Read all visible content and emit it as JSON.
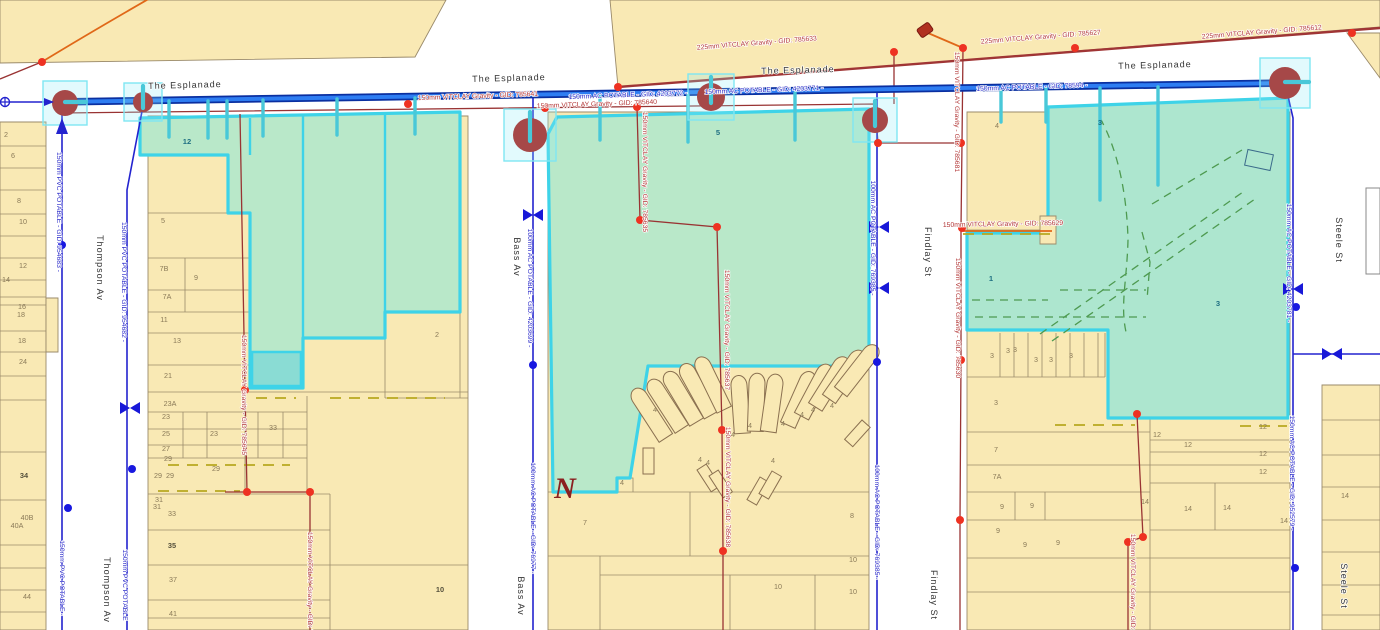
{
  "map": {
    "colors": {
      "water_main": "#2e7df2",
      "water_casing": "#0a2fa0",
      "water_thin": "#2323cf",
      "sewer": "#993333",
      "sewer_trunk": "#a03535",
      "sewer_node": "#ee3222",
      "selection": "#3ed3e8",
      "selection_fill": "#b9e8c9",
      "selection_fill_alt": "#ade6cf",
      "selection_fill_bright": "#8adcd4",
      "parcel_fill": "#f9e9b4",
      "parcel_stroke": "#9a8a6a",
      "easement": "#b8a820",
      "drain_dash": "#4e9a50",
      "manhole": "#a64848",
      "label_blue": "#2929c9",
      "label_red": "#b23535",
      "street_text": "#333333",
      "parcel_text": "#8a7a58",
      "orange": "#e06818"
    },
    "labels": [
      {
        "t": "The Esplanade",
        "x": 185,
        "y": 88,
        "r": -1.5,
        "k": "st"
      },
      {
        "t": "The Esplanade",
        "x": 509,
        "y": 81,
        "r": -1.5,
        "k": "st"
      },
      {
        "t": "The Esplanade",
        "x": 798,
        "y": 73,
        "r": -1.5,
        "k": "st"
      },
      {
        "t": "The Esplanade",
        "x": 1155,
        "y": 68,
        "r": -1.5,
        "k": "st"
      },
      {
        "t": "Thompson Av",
        "x": 97,
        "y": 268,
        "r": 90,
        "k": "st"
      },
      {
        "t": "Thompson Av",
        "x": 104,
        "y": 590,
        "r": 90,
        "k": "st"
      },
      {
        "t": "Bass Av",
        "x": 514,
        "y": 257,
        "r": 90,
        "k": "st"
      },
      {
        "t": "Bass Av",
        "x": 518,
        "y": 596,
        "r": 90,
        "k": "st"
      },
      {
        "t": "Findlay St",
        "x": 925,
        "y": 252,
        "r": 90,
        "k": "st"
      },
      {
        "t": "Findlay St",
        "x": 931,
        "y": 595,
        "r": 90,
        "k": "st"
      },
      {
        "t": "Steele St",
        "x": 1336,
        "y": 240,
        "r": 90,
        "k": "st"
      },
      {
        "t": "Steele St",
        "x": 1341,
        "y": 586,
        "r": 90,
        "k": "st"
      },
      {
        "t": "150mm AC POTABLE - GID: 4203772 -",
        "x": 628,
        "y": 97,
        "r": -2,
        "k": "wb"
      },
      {
        "t": "150mm AC POTABLE - GID: 4203771 -",
        "x": 764,
        "y": 92,
        "r": -2,
        "k": "wb"
      },
      {
        "t": "150mm AC POTABLE - GID: 78594 -",
        "x": 1032,
        "y": 89,
        "r": -2,
        "k": "wb"
      },
      {
        "t": "150mm PVC POTABLE - GID: 954683 -",
        "x": 57,
        "y": 212,
        "r": 90,
        "k": "wb"
      },
      {
        "t": "150mm PVC POTABLE - GID: 954682 -",
        "x": 122,
        "y": 282,
        "r": 90,
        "k": "wb"
      },
      {
        "t": "150mm PVC POTABLE -",
        "x": 60,
        "y": 578,
        "r": 90,
        "k": "wb"
      },
      {
        "t": "150mm PVC POTABLE",
        "x": 123,
        "y": 585,
        "r": 90,
        "k": "wb"
      },
      {
        "t": "100mm AC POTABLE - GID: 4203699 -",
        "x": 528,
        "y": 288,
        "r": 90,
        "k": "wb"
      },
      {
        "t": "100mm AC POTABLE - GID: 76977 -",
        "x": 531,
        "y": 518,
        "r": 90,
        "k": "wb"
      },
      {
        "t": "100mm AC POTABLE - GID: 769385 -",
        "x": 871,
        "y": 238,
        "r": 90,
        "k": "wb"
      },
      {
        "t": "100mm AC POTABLE - GID: 769385 -",
        "x": 875,
        "y": 522,
        "r": 90,
        "k": "wb"
      },
      {
        "t": "150mm AC POTABLE - GID: 4203781 -",
        "x": 1287,
        "y": 263,
        "r": 90,
        "k": "wb"
      },
      {
        "t": "150mm AC POTABLE - GID: 952579 -",
        "x": 1290,
        "y": 473,
        "r": 90,
        "k": "wb"
      },
      {
        "t": "225mm VITCLAY Gravity - GID: 785633",
        "x": 757,
        "y": 45,
        "r": -4.5,
        "k": "sr"
      },
      {
        "t": "225mm VITCLAY Gravity - GID: 785627",
        "x": 1041,
        "y": 39,
        "r": -4.5,
        "k": "sr"
      },
      {
        "t": "225mm VITCLAY Gravity - GID: 785612",
        "x": 1262,
        "y": 34,
        "r": -4.5,
        "k": "sr"
      },
      {
        "t": "150mm VITCLAY Gravity - GID: 785641",
        "x": 478,
        "y": 98,
        "r": -2,
        "k": "sr"
      },
      {
        "t": "150mm VITCLAY Gravity - GID: 785640",
        "x": 597,
        "y": 106,
        "r": -2,
        "k": "sr"
      },
      {
        "t": "150mm VITCLAY Gravity - GID: 785635",
        "x": 643,
        "y": 172,
        "r": 90,
        "k": "sr"
      },
      {
        "t": "150mm VITCLAY Gravity - GID: 785637",
        "x": 725,
        "y": 330,
        "r": 90,
        "k": "sr"
      },
      {
        "t": "150mm VITCLAY Gravity - GID: 785638",
        "x": 726,
        "y": 487,
        "r": 90,
        "k": "sr"
      },
      {
        "t": "150mm VITCLAY Gravity - GID: 785681",
        "x": 955,
        "y": 112,
        "r": 90,
        "k": "sr"
      },
      {
        "t": "150mm VITCLAY Gravity - GID: 785630",
        "x": 956,
        "y": 318,
        "r": 90,
        "k": "sr"
      },
      {
        "t": "150mm VITCLAY Gravity - GID: 785629",
        "x": 1003,
        "y": 226,
        "r": -1,
        "k": "sr"
      },
      {
        "t": "150mm VITCLAY Gravity - GID: 785645",
        "x": 242,
        "y": 395,
        "r": 90,
        "k": "sr"
      },
      {
        "t": "150mm VITCLAY Gravity - GID: 785639",
        "x": 308,
        "y": 592,
        "r": 90,
        "k": "sr"
      },
      {
        "t": "150mm VITCLAY Gravity - GID: 785628",
        "x": 1131,
        "y": 594,
        "r": 90,
        "k": "sr"
      },
      {
        "t": "2",
        "x": 6,
        "y": 137,
        "k": "pc"
      },
      {
        "t": "6",
        "x": 13,
        "y": 158,
        "k": "pc"
      },
      {
        "t": "8",
        "x": 19,
        "y": 203,
        "k": "pc"
      },
      {
        "t": "10",
        "x": 23,
        "y": 224,
        "k": "pc"
      },
      {
        "t": "12",
        "x": 23,
        "y": 268,
        "k": "pc"
      },
      {
        "t": "14",
        "x": 6,
        "y": 282,
        "k": "pc"
      },
      {
        "t": "16",
        "x": 22,
        "y": 309,
        "k": "pc"
      },
      {
        "t": "18",
        "x": 21,
        "y": 317,
        "k": "pc"
      },
      {
        "t": "18",
        "x": 22,
        "y": 343,
        "k": "pc"
      },
      {
        "t": "24",
        "x": 23,
        "y": 364,
        "k": "pc"
      },
      {
        "t": "34",
        "x": 24,
        "y": 478,
        "k": "pb"
      },
      {
        "t": "40B",
        "x": 27,
        "y": 520,
        "k": "pc"
      },
      {
        "t": "40A",
        "x": 17,
        "y": 528,
        "k": "pc"
      },
      {
        "t": "44",
        "x": 27,
        "y": 599,
        "k": "pc"
      },
      {
        "t": "12",
        "x": 187,
        "y": 144,
        "k": "pg"
      },
      {
        "t": "5",
        "x": 163,
        "y": 223,
        "k": "pc"
      },
      {
        "t": "7B",
        "x": 164,
        "y": 271,
        "k": "pc"
      },
      {
        "t": "9",
        "x": 196,
        "y": 280,
        "k": "pc"
      },
      {
        "t": "7A",
        "x": 167,
        "y": 299,
        "k": "pc"
      },
      {
        "t": "11",
        "x": 164,
        "y": 322,
        "k": "pc"
      },
      {
        "t": "13",
        "x": 177,
        "y": 343,
        "k": "pc"
      },
      {
        "t": "21",
        "x": 168,
        "y": 378,
        "k": "pc"
      },
      {
        "t": "23A",
        "x": 170,
        "y": 406,
        "k": "pc"
      },
      {
        "t": "23",
        "x": 166,
        "y": 419,
        "k": "pc"
      },
      {
        "t": "25",
        "x": 166,
        "y": 436,
        "k": "pc"
      },
      {
        "t": "23",
        "x": 214,
        "y": 436,
        "k": "pc"
      },
      {
        "t": "27",
        "x": 166,
        "y": 451,
        "k": "pc"
      },
      {
        "t": "29",
        "x": 168,
        "y": 461,
        "k": "pc"
      },
      {
        "t": "29",
        "x": 216,
        "y": 471,
        "k": "pc"
      },
      {
        "t": "29",
        "x": 158,
        "y": 478,
        "k": "pc"
      },
      {
        "t": "29",
        "x": 170,
        "y": 478,
        "k": "pc"
      },
      {
        "t": "31",
        "x": 159,
        "y": 502,
        "k": "pc"
      },
      {
        "t": "31",
        "x": 157,
        "y": 509,
        "k": "pc"
      },
      {
        "t": "33",
        "x": 172,
        "y": 516,
        "k": "pc"
      },
      {
        "t": "33",
        "x": 273,
        "y": 430,
        "k": "pc"
      },
      {
        "t": "35",
        "x": 172,
        "y": 548,
        "k": "pb"
      },
      {
        "t": "37",
        "x": 173,
        "y": 582,
        "k": "pc"
      },
      {
        "t": "41",
        "x": 173,
        "y": 616,
        "k": "pc"
      },
      {
        "t": "2",
        "x": 437,
        "y": 337,
        "k": "pc"
      },
      {
        "t": "10",
        "x": 440,
        "y": 592,
        "k": "pb"
      },
      {
        "t": "5",
        "x": 718,
        "y": 135,
        "k": "pg"
      },
      {
        "t": "4",
        "x": 655,
        "y": 412,
        "k": "pc"
      },
      {
        "t": "4",
        "x": 733,
        "y": 437,
        "k": "pc"
      },
      {
        "t": "4",
        "x": 750,
        "y": 428,
        "k": "pc"
      },
      {
        "t": "4",
        "x": 783,
        "y": 426,
        "k": "pc"
      },
      {
        "t": "4",
        "x": 802,
        "y": 417,
        "k": "pc"
      },
      {
        "t": "4",
        "x": 813,
        "y": 412,
        "k": "pc"
      },
      {
        "t": "4",
        "x": 832,
        "y": 408,
        "k": "pc"
      },
      {
        "t": "4",
        "x": 700,
        "y": 462,
        "k": "pc"
      },
      {
        "t": "4",
        "x": 708,
        "y": 465,
        "k": "pc"
      },
      {
        "t": "4",
        "x": 773,
        "y": 463,
        "k": "pc"
      },
      {
        "t": "4",
        "x": 622,
        "y": 485,
        "k": "pc"
      },
      {
        "t": "7",
        "x": 585,
        "y": 525,
        "k": "pc"
      },
      {
        "t": "8",
        "x": 852,
        "y": 518,
        "k": "pc"
      },
      {
        "t": "10",
        "x": 778,
        "y": 589,
        "k": "pc"
      },
      {
        "t": "10",
        "x": 853,
        "y": 562,
        "k": "pc"
      },
      {
        "t": "10",
        "x": 853,
        "y": 594,
        "k": "pc"
      },
      {
        "t": "4",
        "x": 997,
        "y": 128,
        "k": "pc"
      },
      {
        "t": "3",
        "x": 1100,
        "y": 125,
        "k": "pg"
      },
      {
        "t": "1",
        "x": 991,
        "y": 281,
        "k": "pg"
      },
      {
        "t": "3",
        "x": 1218,
        "y": 306,
        "k": "pg"
      },
      {
        "t": "3",
        "x": 992,
        "y": 358,
        "k": "pc"
      },
      {
        "t": "3",
        "x": 1008,
        "y": 353,
        "k": "pc"
      },
      {
        "t": "3",
        "x": 1015,
        "y": 352,
        "k": "pc"
      },
      {
        "t": "3",
        "x": 1036,
        "y": 362,
        "k": "pc"
      },
      {
        "t": "3",
        "x": 1051,
        "y": 362,
        "k": "pc"
      },
      {
        "t": "3",
        "x": 1071,
        "y": 358,
        "k": "pc"
      },
      {
        "t": "3",
        "x": 996,
        "y": 405,
        "k": "pc"
      },
      {
        "t": "7",
        "x": 996,
        "y": 452,
        "k": "pc"
      },
      {
        "t": "7A",
        "x": 997,
        "y": 479,
        "k": "pc"
      },
      {
        "t": "9",
        "x": 1002,
        "y": 509,
        "k": "pc"
      },
      {
        "t": "9",
        "x": 1032,
        "y": 508,
        "k": "pc"
      },
      {
        "t": "9",
        "x": 998,
        "y": 533,
        "k": "pc"
      },
      {
        "t": "9",
        "x": 1025,
        "y": 547,
        "k": "pc"
      },
      {
        "t": "9",
        "x": 1058,
        "y": 545,
        "k": "pc"
      },
      {
        "t": "12",
        "x": 1157,
        "y": 437,
        "k": "pc"
      },
      {
        "t": "12",
        "x": 1188,
        "y": 447,
        "k": "pc"
      },
      {
        "t": "12",
        "x": 1263,
        "y": 429,
        "k": "pc"
      },
      {
        "t": "12",
        "x": 1263,
        "y": 456,
        "k": "pc"
      },
      {
        "t": "12",
        "x": 1263,
        "y": 474,
        "k": "pc"
      },
      {
        "t": "14",
        "x": 1145,
        "y": 504,
        "k": "pc"
      },
      {
        "t": "14",
        "x": 1188,
        "y": 511,
        "k": "pc"
      },
      {
        "t": "14",
        "x": 1227,
        "y": 510,
        "k": "pc"
      },
      {
        "t": "14",
        "x": 1284,
        "y": 523,
        "k": "pc"
      },
      {
        "t": "14",
        "x": 1345,
        "y": 498,
        "k": "pc"
      },
      {
        "t": "N",
        "x": 565,
        "y": 498,
        "k": "nm"
      }
    ],
    "symbols": {
      "manholes": [
        {
          "x": 65,
          "y": 103,
          "r": 13,
          "plug": "h"
        },
        {
          "x": 143,
          "y": 102,
          "r": 10,
          "plug": "v"
        },
        {
          "x": 530,
          "y": 135,
          "r": 17,
          "plug": "v"
        },
        {
          "x": 711,
          "y": 97,
          "r": 14,
          "plug": "v"
        },
        {
          "x": 875,
          "y": 120,
          "r": 13,
          "plug": "v"
        },
        {
          "x": 1285,
          "y": 83,
          "r": 16,
          "plug": "h"
        }
      ],
      "valves": [
        {
          "x": 533,
          "y": 215
        },
        {
          "x": 879,
          "y": 227
        },
        {
          "x": 879,
          "y": 288
        },
        {
          "x": 130,
          "y": 408
        },
        {
          "x": 1293,
          "y": 289
        },
        {
          "x": 1332,
          "y": 354
        }
      ],
      "water_junctions": [
        {
          "x": 62,
          "y": 245
        },
        {
          "x": 68,
          "y": 508
        },
        {
          "x": 132,
          "y": 469
        },
        {
          "x": 533,
          "y": 365
        },
        {
          "x": 877,
          "y": 362
        },
        {
          "x": 1296,
          "y": 307
        },
        {
          "x": 1295,
          "y": 568
        }
      ],
      "sewer_nodes": [
        {
          "x": 42,
          "y": 62
        },
        {
          "x": 408,
          "y": 104
        },
        {
          "x": 545,
          "y": 108
        },
        {
          "x": 618,
          "y": 87
        },
        {
          "x": 637,
          "y": 107
        },
        {
          "x": 640,
          "y": 220
        },
        {
          "x": 717,
          "y": 227
        },
        {
          "x": 722,
          "y": 430
        },
        {
          "x": 723,
          "y": 551
        },
        {
          "x": 245,
          "y": 390
        },
        {
          "x": 247,
          "y": 492
        },
        {
          "x": 310,
          "y": 492
        },
        {
          "x": 894,
          "y": 52
        },
        {
          "x": 963,
          "y": 48
        },
        {
          "x": 878,
          "y": 143
        },
        {
          "x": 961,
          "y": 143
        },
        {
          "x": 962,
          "y": 228
        },
        {
          "x": 961,
          "y": 360
        },
        {
          "x": 960,
          "y": 520
        },
        {
          "x": 1075,
          "y": 48
        },
        {
          "x": 1352,
          "y": 33
        },
        {
          "x": 1137,
          "y": 414
        },
        {
          "x": 1143,
          "y": 537
        },
        {
          "x": 1128,
          "y": 542
        }
      ],
      "service_stubs": [
        {
          "x": 169,
          "y1": 101,
          "y2": 137
        },
        {
          "x": 208,
          "y1": 101,
          "y2": 138
        },
        {
          "x": 227,
          "y1": 101,
          "y2": 138
        },
        {
          "x": 263,
          "y1": 100,
          "y2": 136
        },
        {
          "x": 337,
          "y1": 99,
          "y2": 135
        },
        {
          "x": 415,
          "y1": 98,
          "y2": 134
        },
        {
          "x": 600,
          "y1": 96,
          "y2": 140
        },
        {
          "x": 688,
          "y1": 95,
          "y2": 142
        },
        {
          "x": 795,
          "y1": 93,
          "y2": 140
        },
        {
          "x": 1001,
          "y1": 90,
          "y2": 122
        },
        {
          "x": 1046,
          "y1": 89,
          "y2": 122
        },
        {
          "x": 1100,
          "y1": 88,
          "y2": 200
        },
        {
          "x": 1158,
          "y1": 87,
          "y2": 185
        }
      ],
      "flow_arrows": [
        {
          "x": 50,
          "y": 102,
          "dir": "right"
        },
        {
          "x": 62,
          "y": 126,
          "dir": "up"
        }
      ],
      "source_marker": {
        "x": 5,
        "y": 102
      },
      "pump_marker": {
        "x": 925,
        "y": 30
      }
    }
  }
}
